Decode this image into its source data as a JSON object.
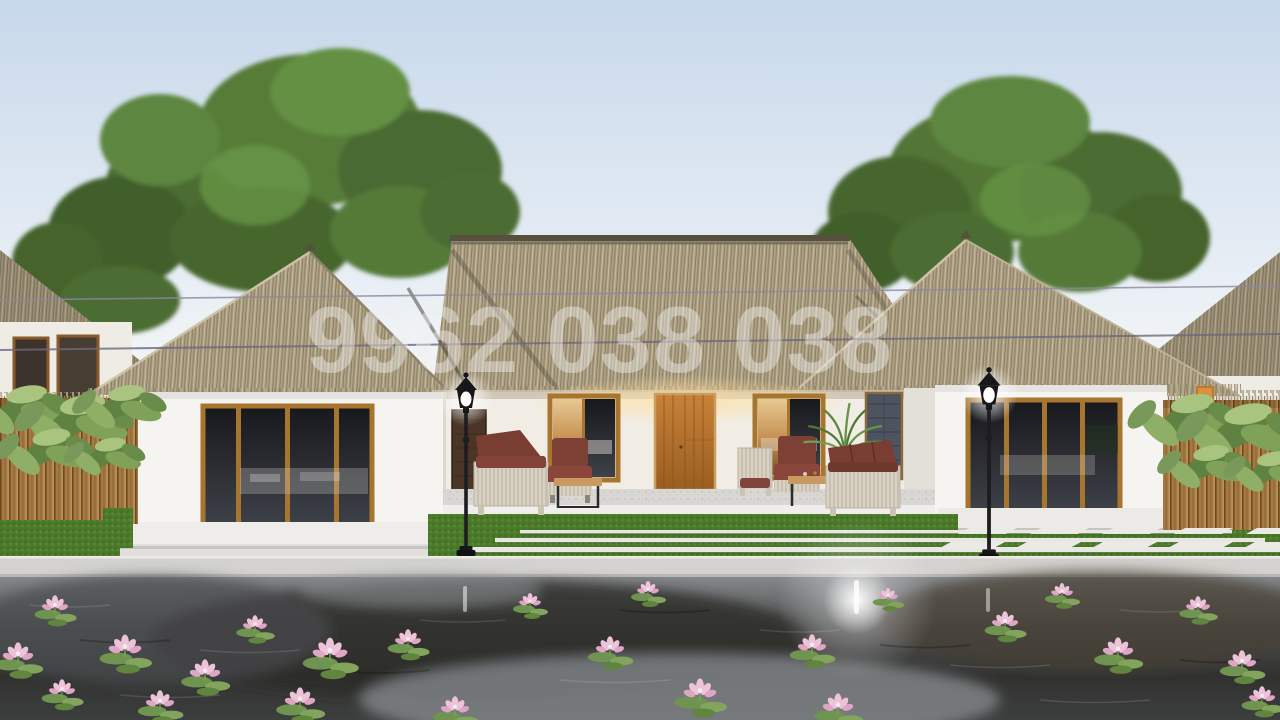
{
  "image": {
    "type": "exterior-3d-render",
    "subject": "Single-story white villa with thatched hip roofs, central porch with wicker seating, two black lamp posts, lawn with stone strips and stepping slabs, bamboo fences with tropical plants, large green trees behind, and a dark lotus pond in the foreground",
    "watermark_text": "9962 038 038"
  },
  "palette": {
    "sky_top": "#c7d8eb",
    "sky_horizon": "#f7f8f7",
    "thatch": "#ab9e83",
    "thatch_shadow": "#7b6f58",
    "ridge_cap": "#57503f",
    "wall_white": "#f4f2ee",
    "wood_frame": "#a8752f",
    "entry_door_wood": "#b5722e",
    "glass_dark": "#26282c",
    "grass": "#4c7a2b",
    "stone_strip": "#e8e7e3",
    "walkway": "#d3d2ce",
    "pond_dark": "#2b2a27",
    "pond_reflection": "#888c90",
    "lily_pad": "#6f9450",
    "lotus_pink": "#ecc3d8",
    "cushion_maroon": "#7d4034",
    "wicker": "#d9d2c3",
    "lamp_black": "#17171a",
    "fence_wood": "#a5793f",
    "foliage_green": "#557b38"
  },
  "counts": {
    "lamp_posts": 2,
    "large_trees": 2,
    "porch_windows": 2,
    "glass_door_walls": 2,
    "entry_doors": 1
  }
}
